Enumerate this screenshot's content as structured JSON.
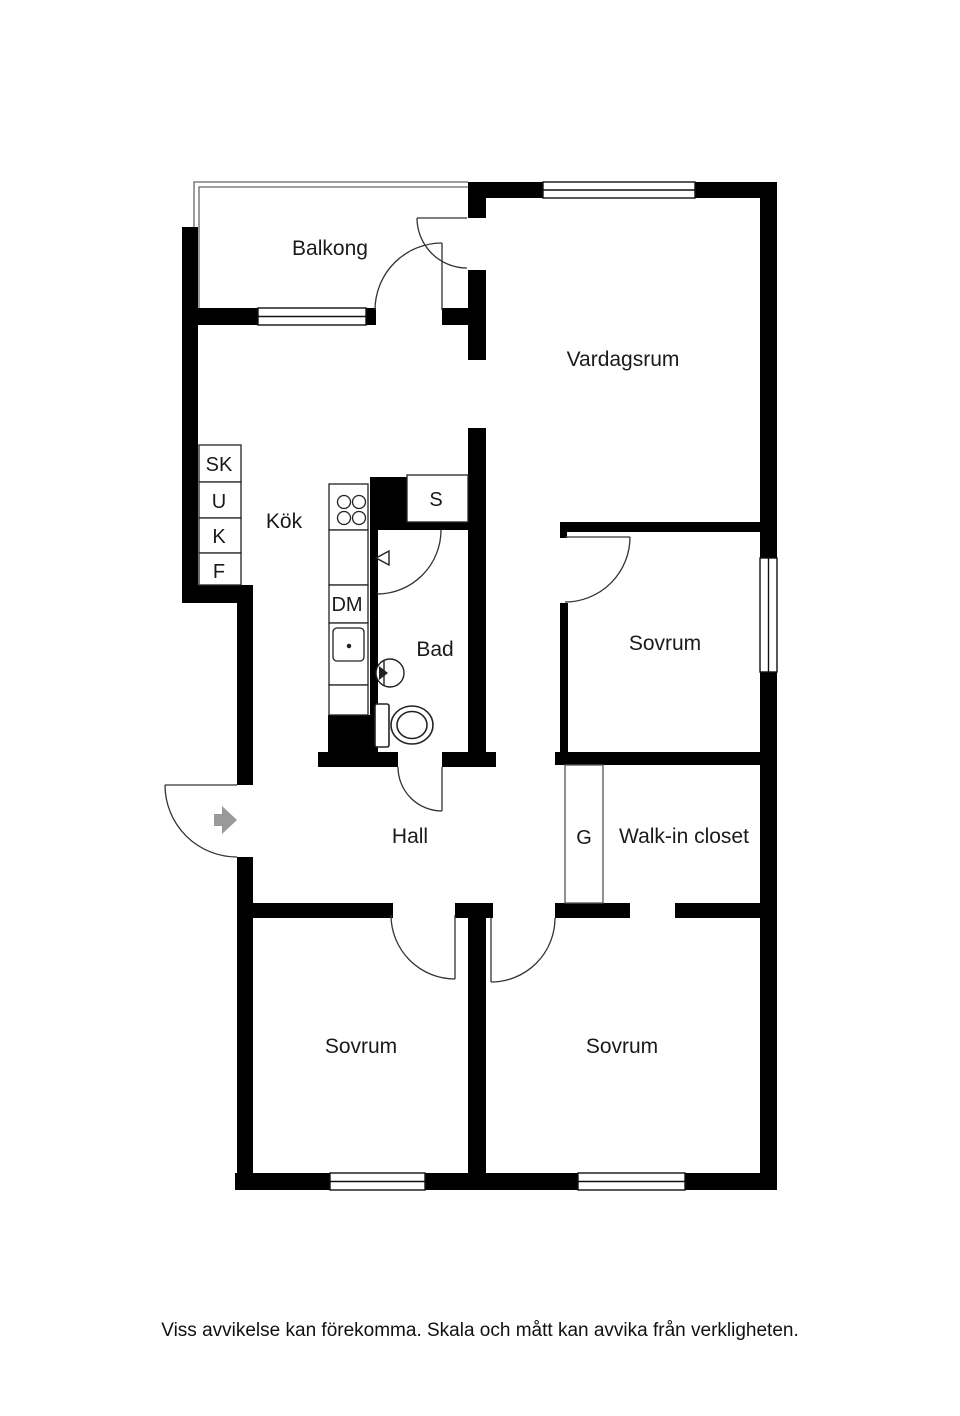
{
  "plan": {
    "rooms": {
      "balkong": "Balkong",
      "vardagsrum": "Vardagsrum",
      "kok": "Kök",
      "bad": "Bad",
      "sovrum_ne": "Sovrum",
      "hall": "Hall",
      "walk_in_closet": "Walk-in closet",
      "sovrum_sw": "Sovrum",
      "sovrum_se": "Sovrum"
    },
    "closets": {
      "sk": "SK",
      "u": "U",
      "k": "K",
      "f": "F",
      "s": "S",
      "g": "G"
    },
    "appliances": {
      "dm": "DM"
    },
    "colors": {
      "wall": "#000000",
      "thin_line": "#222222",
      "door_line": "#333333",
      "railing": "#666666",
      "entry_arrow": "#999999"
    }
  },
  "footer": {
    "disclaimer": "Viss avvikelse kan förekomma. Skala och mått kan avvika från verkligheten."
  }
}
